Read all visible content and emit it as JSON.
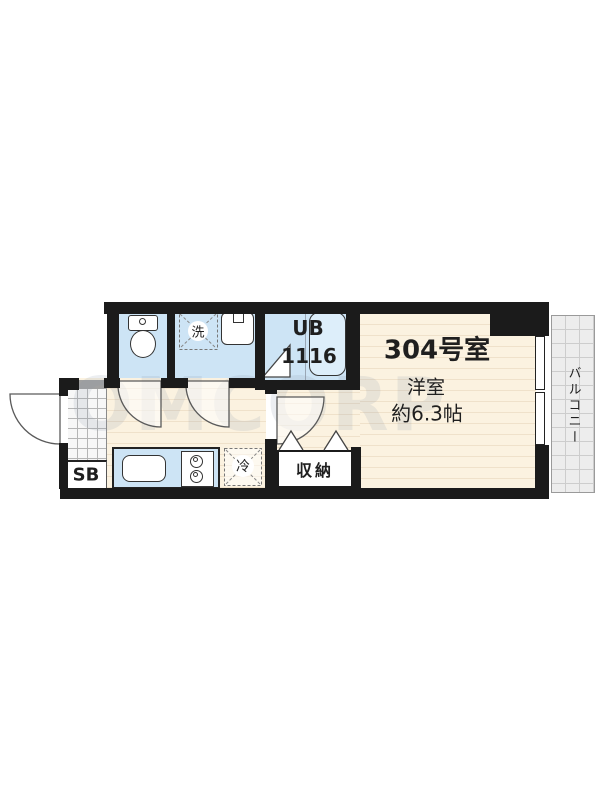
{
  "floorplan": {
    "unit_label": "304号室",
    "main_room": {
      "type_label": "洋室",
      "size_label": "約6.3帖"
    },
    "bath": {
      "label": "UB",
      "size": "1116"
    },
    "balcony_label": "バルコニー",
    "closet_label": "収納",
    "fridge_label": "冷",
    "washer_label": "洗",
    "shoebox_label": "SB",
    "watermark": "OMCORP"
  },
  "colors": {
    "wall": "#1b1b1b",
    "wet_room_fill": "#cde4f5",
    "floor_fill": "#fbf2e0",
    "floor_line": "#efe1ca",
    "balcony_fill": "#ededed",
    "text": "#1f1f1f"
  }
}
